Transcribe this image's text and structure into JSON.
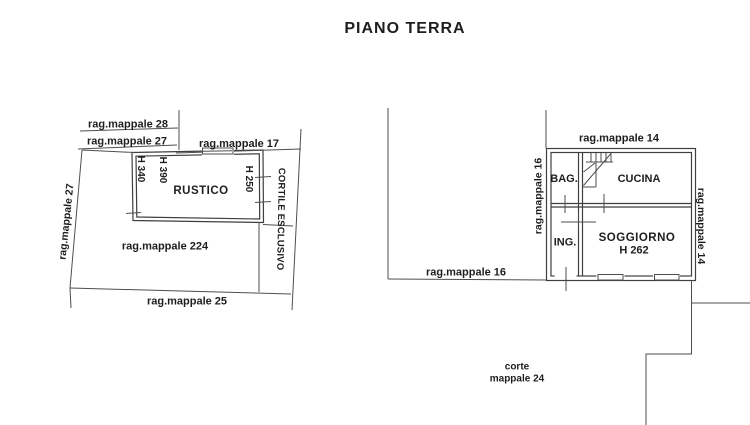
{
  "title": "PIANO TERRA",
  "colors": {
    "background": "#ffffff",
    "line": "#4e4e4e",
    "wall": "#3f3f3f",
    "text": "#1e1e1e"
  },
  "left_plan": {
    "parcel_28": "rag.mappale 28",
    "parcel_27_top": "rag.mappale 27",
    "parcel_17": "rag.mappale 17",
    "parcel_27_left": "rag.mappale 27",
    "parcel_224": "rag.mappale 224",
    "parcel_25": "rag.mappale 25",
    "courtyard": "CORTILE ESCLUSIVO",
    "room": "RUSTICO",
    "height_340": "H 340",
    "height_390": "H 390",
    "height_250": "H 250"
  },
  "right_plan": {
    "parcel_14_top": "rag.mappale 14",
    "parcel_16_left": "rag.mappale 16",
    "parcel_14_right": "rag.mappale 14",
    "parcel_16_bottom": "rag.mappale 16",
    "room_bath": "BAG.",
    "room_kitchen": "CUCINA",
    "room_entry": "ING.",
    "room_living": "SOGGIORNO",
    "living_height": "H 262",
    "court_line1": "corte",
    "court_line2": "mappale 24"
  }
}
